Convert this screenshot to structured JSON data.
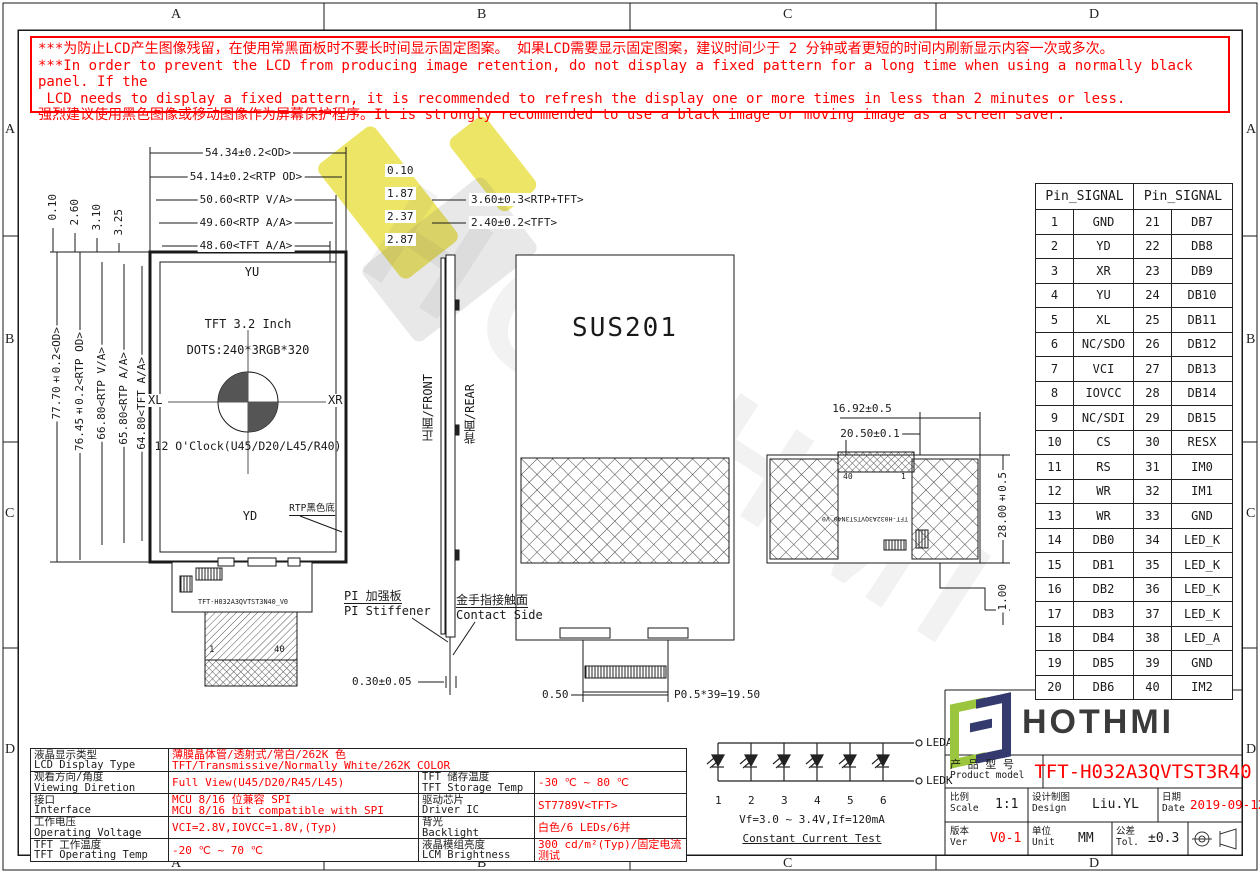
{
  "border": {
    "top": [
      "A",
      "B",
      "C",
      "D"
    ],
    "bottom": [
      "A",
      "B",
      "C",
      "D"
    ],
    "left": [
      "A",
      "B",
      "C",
      "D"
    ],
    "right": [
      "A",
      "B",
      "C",
      "D"
    ]
  },
  "warning": {
    "lines": [
      "***为防止LCD产生图像残留，在使用常黑面板时不要长时间显示固定图案。 如果LCD需要显示固定图案，建议时间少于 2 分钟或者更短的时间内刷新显示内容一次或多次。",
      "***In order to prevent the LCD from producing image retention, do not display a fixed pattern for a long time when using a normally black panel. If the",
      " LCD needs to display a fixed pattern, it is recommended to refresh the display one or more times in less than 2 minutes or less.",
      "强烈建议使用黑色图像或移动图像作为屏幕保护程序。It is strongly recommended to use a black image or moving image as a screen saver."
    ]
  },
  "front_view": {
    "h_dims": [
      "54.34±0.2<OD>",
      "54.14±0.2<RTP OD>",
      "50.60<RTP V/A>",
      "49.60<RTP A/A>",
      "48.60<TFT A/A>"
    ],
    "h_dim_offsets": [
      "0.10",
      "1.87",
      "2.37",
      "2.87"
    ],
    "thickness_dims": [
      "3.60±0.3<RTP+TFT>",
      "2.40±0.2<TFT>"
    ],
    "v_dims": [
      "77.70±0.2<OD>",
      "76.45±0.2<RTP OD>",
      "66.80<RTP V/A>",
      "65.80<RTP A/A>",
      "64.80<TFT A/A>"
    ],
    "v_dim_offsets": [
      "0.10",
      "2.60",
      "3.10",
      "3.25"
    ],
    "labels": {
      "top": "YU",
      "bottom": "YD",
      "left": "XL",
      "right": "XR"
    },
    "size_text": "TFT 3.2 Inch",
    "dots_text": "DOTS:240*3RGB*320",
    "clock_text": "12 O'Clock(U45/D20/L45/R40)",
    "rtp_note": "RTP黑色底",
    "fpc_label": "TFT-H032A3QVTST3N40_V0",
    "pin_first": "1",
    "pin_last": "40"
  },
  "side_view": {
    "front_label": "正面/FRONT",
    "rear_label": "背面/REAR",
    "stiffener_cn": "PI 加强板",
    "stiffener_en": "PI Stiffener",
    "contact_cn": "金手指接触面",
    "contact_en": "Contact Side",
    "thickness": "0.30±0.05"
  },
  "rear_view": {
    "shield": "SUS201",
    "dim_offset": "0.50",
    "dim_pitch": "P0.5*39=19.50"
  },
  "rear_view2": {
    "dim1": "16.92±0.5",
    "dim2": "20.50±0.1",
    "dim3": "28.00±0.5",
    "dim4": "1.00",
    "pin_last": "40",
    "pin_first": "1",
    "fpc_label": "TFT-H032A3QVTST3N40_V0"
  },
  "pin_table": {
    "headers": [
      "Pin_SIGNAL",
      "Pin_SIGNAL"
    ],
    "rows": [
      {
        "p1": "1",
        "s1": "GND",
        "p2": "21",
        "s2": "DB7"
      },
      {
        "p1": "2",
        "s1": "YD",
        "p2": "22",
        "s2": "DB8"
      },
      {
        "p1": "3",
        "s1": "XR",
        "p2": "23",
        "s2": "DB9"
      },
      {
        "p1": "4",
        "s1": "YU",
        "p2": "24",
        "s2": "DB10"
      },
      {
        "p1": "5",
        "s1": "XL",
        "p2": "25",
        "s2": "DB11"
      },
      {
        "p1": "6",
        "s1": "NC/SDO",
        "p2": "26",
        "s2": "DB12"
      },
      {
        "p1": "7",
        "s1": "VCI",
        "p2": "27",
        "s2": "DB13"
      },
      {
        "p1": "8",
        "s1": "IOVCC",
        "p2": "28",
        "s2": "DB14"
      },
      {
        "p1": "9",
        "s1": "NC/SDI",
        "p2": "29",
        "s2": "DB15"
      },
      {
        "p1": "10",
        "s1": "CS",
        "p2": "30",
        "s2": "RESX"
      },
      {
        "p1": "11",
        "s1": "RS",
        "p2": "31",
        "s2": "IM0"
      },
      {
        "p1": "12",
        "s1": "WR",
        "p2": "32",
        "s2": "IM1"
      },
      {
        "p1": "13",
        "s1": "WR",
        "p2": "33",
        "s2": "GND"
      },
      {
        "p1": "14",
        "s1": "DB0",
        "p2": "34",
        "s2": "LED_K"
      },
      {
        "p1": "15",
        "s1": "DB1",
        "p2": "35",
        "s2": "LED_K"
      },
      {
        "p1": "16",
        "s1": "DB2",
        "p2": "36",
        "s2": "LED_K"
      },
      {
        "p1": "17",
        "s1": "DB3",
        "p2": "37",
        "s2": "LED_K"
      },
      {
        "p1": "18",
        "s1": "DB4",
        "p2": "38",
        "s2": "LED_A"
      },
      {
        "p1": "19",
        "s1": "DB5",
        "p2": "39",
        "s2": "GND"
      },
      {
        "p1": "20",
        "s1": "DB6",
        "p2": "40",
        "s2": "IM2"
      }
    ]
  },
  "spec_table": {
    "rows": [
      {
        "label_cn": "液晶显示类型",
        "label_en": "LCD Display Type",
        "value": "薄膜晶体管/透射式/常白/262K 色\nTFT/Transmissive/Normally White/262K COLOR",
        "span": true
      },
      {
        "label_cn": "观看方向/角度",
        "label_en": "Viewing Diretion",
        "value": "Full View(U45/D20/R45/L45)",
        "label2_cn": "TFT 储存温度",
        "label2_en": "TFT Storage Temp",
        "value2": "-30 ℃ ~ 80 ℃"
      },
      {
        "label_cn": "接口",
        "label_en": "Interface",
        "value": "MCU 8/16 位兼容 SPI\nMCU 8/16 bit compatible with SPI",
        "label2_cn": "驱动芯片",
        "label2_en": "Driver IC",
        "value2": "ST7789V<TFT>"
      },
      {
        "label_cn": "工作电压",
        "label_en": "Operating Voltage",
        "value": "VCI=2.8V,IOVCC=1.8V,(Typ)",
        "label2_cn": "背光",
        "label2_en": "Backlight",
        "value2": "白色/6 LEDs/6并"
      },
      {
        "label_cn": "TFT 工作温度",
        "label_en": "TFT Operating Temp",
        "value": "-20 ℃ ~ 70 ℃",
        "label2_cn": "液晶模组亮度",
        "label2_en": "LCM Brightness",
        "value2": "300 cd/m²(Typ)/固定电流测试"
      }
    ]
  },
  "led_circuit": {
    "anode": "LEDA",
    "cathode": "LEDK",
    "numbers": [
      "1",
      "2",
      "3",
      "4",
      "5",
      "6"
    ],
    "vf": "Vf=3.0 ~ 3.4V,If=120mA",
    "test": "Constant Current Test"
  },
  "title_block": {
    "brand": "HOTHMI",
    "model_label_cn": "产 品 型 号",
    "model_label_en": "Product model",
    "model": "TFT-H032A3QVTST3R40",
    "scale_cn": "比例",
    "scale_en": "Scale",
    "scale": "1:1",
    "design_cn": "设计制图",
    "design_en": "Design",
    "designer": "Liu.YL",
    "date_cn": "日期",
    "date_en": "Date",
    "date": "2019-09-12",
    "ver_cn": "版本",
    "ver_en": "Ver",
    "ver": "V0-1",
    "unit_cn": "单位",
    "unit_en": "Unit",
    "unit": "MM",
    "tol_cn": "公差",
    "tol_en": "Tol.",
    "tol": "±0.3"
  },
  "watermark": {
    "text": "HOTHMI"
  },
  "colors": {
    "red": "#ff0000",
    "line": "#1a1a1a",
    "logo_green": "#9bc53d",
    "logo_navy": "#343a6e",
    "brand_gray": "#3a3a3a",
    "wm_yellow": "#e9df3f"
  }
}
